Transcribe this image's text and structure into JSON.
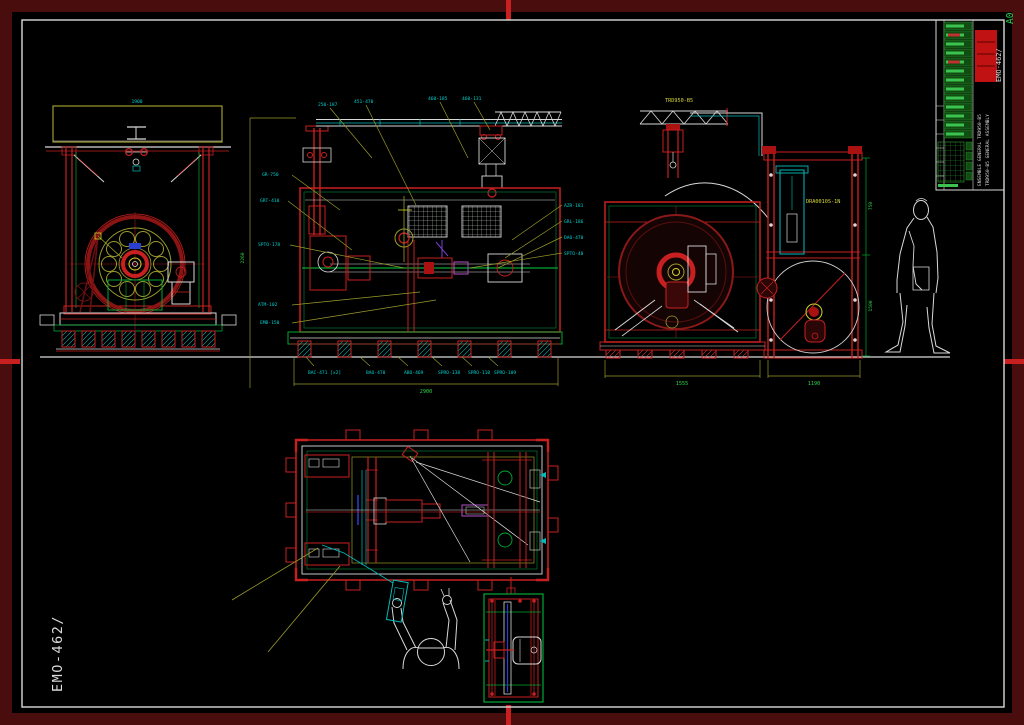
{
  "palette": {
    "background": "#000000",
    "border_band": "#4a0d0d",
    "frame_line": "#d9d9d9",
    "red": "#c82020",
    "dark_red": "#6e0f0f",
    "green": "#00a832",
    "olive": "#9c9c2a",
    "yellow": "#d2d22a",
    "cyan": "#00bcbc",
    "blue": "#2b3fd0",
    "magenta": "#b44fc8",
    "logo_red": "#c01212",
    "table_green": "#114d13"
  },
  "sheet": {
    "format_label": "A0",
    "margin_number": "EMO-462/"
  },
  "title_block": {
    "number": "EMO-462/",
    "title_line1": "ENSEMBLE GENERAL TRD950-B5",
    "title_line2": "TRD950-B5 GENERAL ASSEMBLY"
  },
  "labels": {
    "hoist": "TRD950-B5",
    "chute": "DRA0010S-1N",
    "view1_width": "1900"
  },
  "dims": {
    "view2_height": "2260",
    "view2_width": "2900",
    "view3_width": "1555",
    "reel_width": "1190",
    "reel_upper": "750",
    "reel_lower": "1500"
  },
  "callouts": {
    "top": [
      "250-187",
      "451-470",
      "460-185",
      "460-131"
    ],
    "left": [
      "GR-750",
      "GRT-410",
      "SPTO-178",
      "ATM-102",
      "EMB-150"
    ],
    "right": [
      "AZR-181",
      "GRL-186",
      "DAO-470",
      "SPTO-40"
    ],
    "bottom": [
      "BAC-471 [x2]",
      "BAO-470",
      "ABO-469",
      "SPRO-138",
      "SPRO-110",
      "SPRO-109"
    ]
  }
}
